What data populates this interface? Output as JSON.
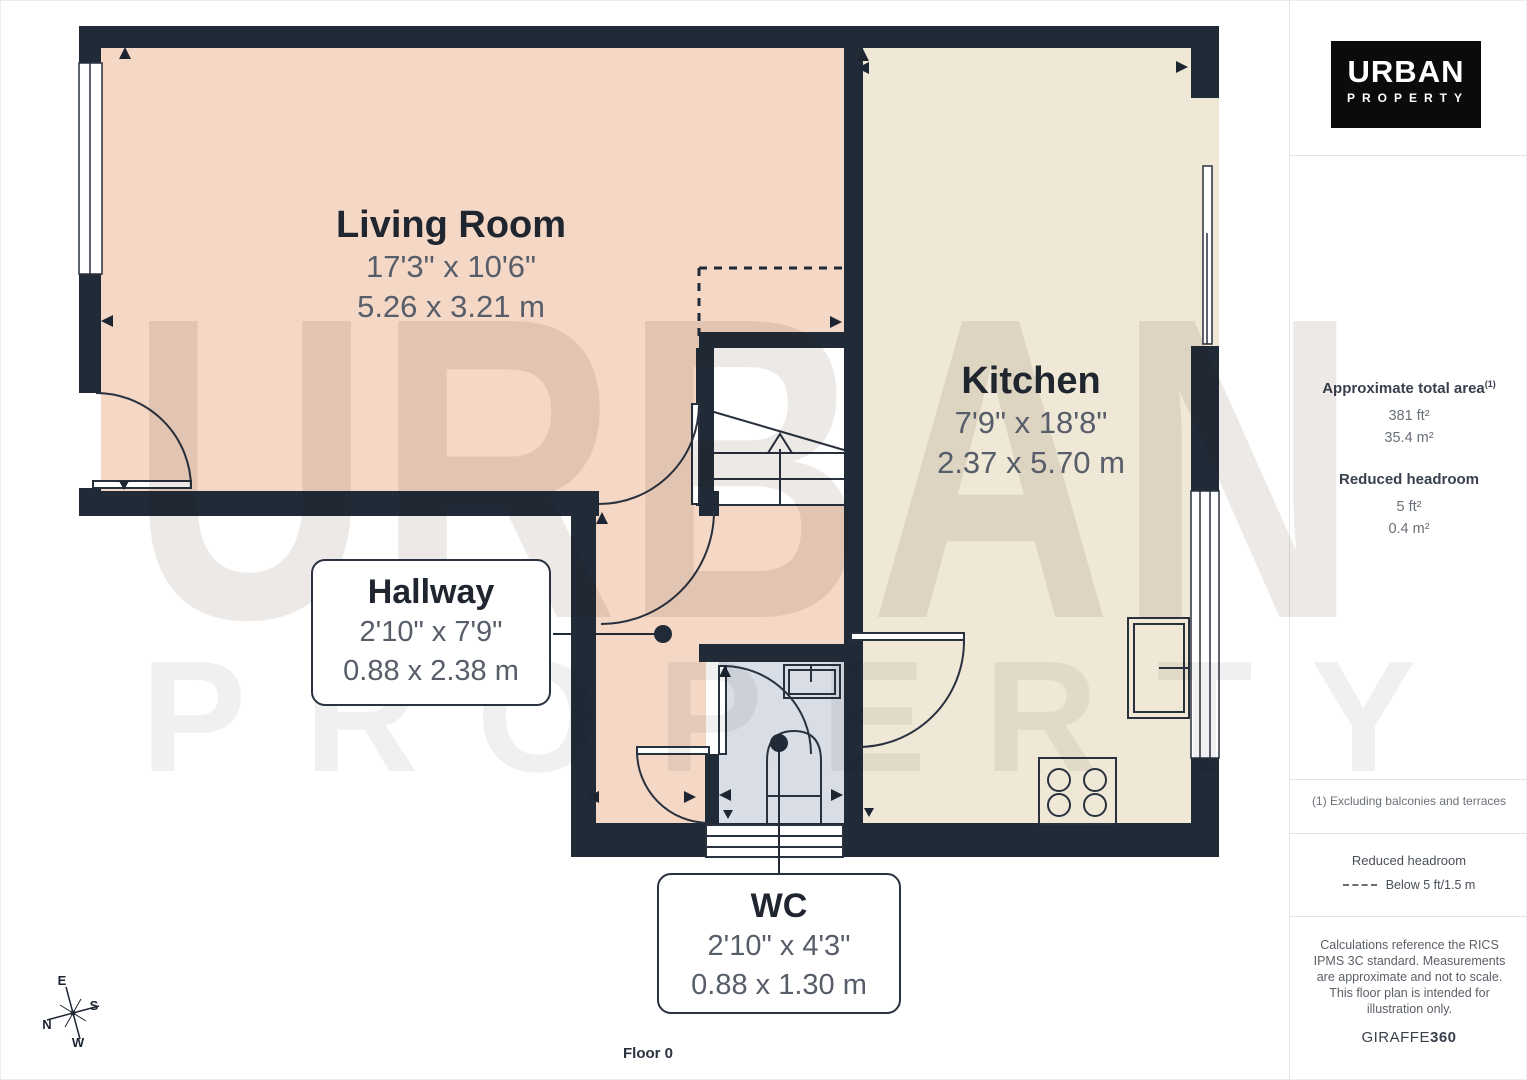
{
  "floorplan": {
    "floor_label": "Floor 0",
    "watermark_line1": "URBAN",
    "watermark_line2": "PROPERTY",
    "rooms": [
      {
        "name": "Living Room",
        "dim_ft": "17'3\" x 10'6\"",
        "dim_m": "5.26 x 3.21 m"
      },
      {
        "name": "Kitchen",
        "dim_ft": "7'9\" x 18'8\"",
        "dim_m": "2.37 x 5.70 m"
      },
      {
        "name": "Hallway",
        "dim_ft": "2'10\" x 7'9\"",
        "dim_m": "0.88 x 2.38 m"
      },
      {
        "name": "WC",
        "dim_ft": "2'10\" x 4'3\"",
        "dim_m": "0.88 x 1.30 m"
      }
    ],
    "compass": {
      "n": "N",
      "e": "E",
      "s": "S",
      "w": "W"
    }
  },
  "sidebar": {
    "logo": {
      "line1": "URBAN",
      "line2": "PROPERTY"
    },
    "area_title": "Approximate total area",
    "area_sup": "(1)",
    "area_ft": "381 ft²",
    "area_m": "35.4 m²",
    "headroom_title": "Reduced headroom",
    "headroom_ft": "5 ft²",
    "headroom_m": "0.4 m²",
    "note": "(1) Excluding balconies and terraces",
    "legend_title": "Reduced headroom",
    "legend_item": "Below 5 ft/1.5 m",
    "disclaimer": "Calculations reference the RICS IPMS 3C standard. Measurements are approximate and not to scale. This floor plan is intended for illustration only.",
    "brand": "GIRAFFE",
    "brand_bold": "360"
  },
  "colors": {
    "wall": "#212b38",
    "living_room_floor": "#f4d7c5",
    "kitchen_floor": "#efe8d6",
    "wc_floor": "#d9dde6",
    "line": "#29313f"
  }
}
